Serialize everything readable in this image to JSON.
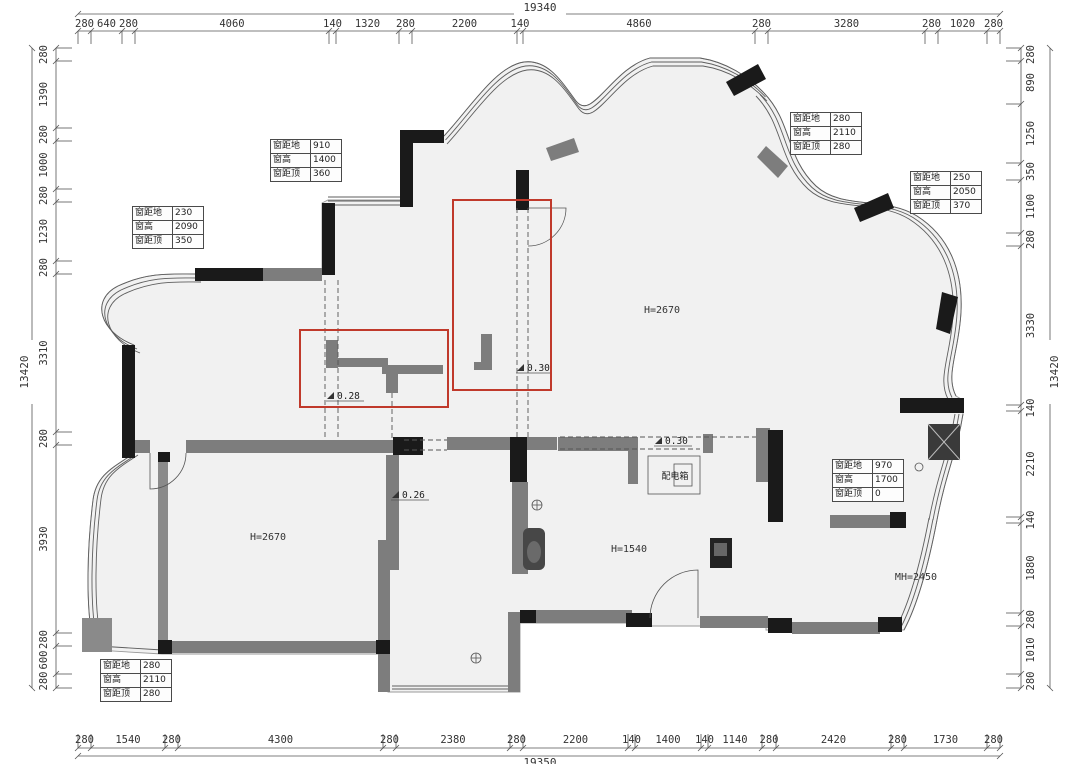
{
  "colors": {
    "wall_black": "#1a1a1a",
    "wall_gray": "#7d7d7d",
    "floor_fill": "#f1f1f1",
    "highlight_red": "#c0392b",
    "dim_line": "#555555"
  },
  "dimensions": {
    "top": {
      "total": "19340",
      "segments": [
        "280",
        "640",
        "280",
        "4060",
        "140",
        "1320",
        "280",
        "2200",
        "140",
        "4860",
        "280",
        "3280",
        "280",
        "1020",
        "280"
      ]
    },
    "bottom": {
      "total": "19350",
      "segments": [
        "280",
        "1540",
        "280",
        "4300",
        "280",
        "2380",
        "280",
        "2200",
        "140",
        "1400",
        "140",
        "1140",
        "280",
        "2420",
        "280",
        "1730",
        "280"
      ]
    },
    "left": {
      "total": "13420",
      "segments": [
        "280",
        "1390",
        "280",
        "1000",
        "280",
        "1230",
        "280",
        "3310",
        "280",
        "3930",
        "280",
        "600",
        "280"
      ]
    },
    "right": {
      "total": "13420",
      "segments": [
        "280",
        "890",
        "1250",
        "350",
        "1100",
        "280",
        "3330",
        "140",
        "2210",
        "140",
        "1880",
        "280",
        "1010",
        "280"
      ]
    }
  },
  "window_annotations": [
    {
      "id": "top-left-window",
      "rows": [
        {
          "label": "窗距地",
          "value": "910"
        },
        {
          "label": "窗高",
          "value": "1400"
        },
        {
          "label": "窗距顶",
          "value": "360"
        }
      ]
    },
    {
      "id": "left-bay-window",
      "rows": [
        {
          "label": "窗距地",
          "value": "230"
        },
        {
          "label": "窗高",
          "value": "2090"
        },
        {
          "label": "窗距顶",
          "value": "350"
        }
      ]
    },
    {
      "id": "top-right-window",
      "rows": [
        {
          "label": "窗距地",
          "value": "280"
        },
        {
          "label": "窗高",
          "value": "2110"
        },
        {
          "label": "窗距顶",
          "value": "280"
        }
      ]
    },
    {
      "id": "right-bay-window",
      "rows": [
        {
          "label": "窗距地",
          "value": "250"
        },
        {
          "label": "窗高",
          "value": "2050"
        },
        {
          "label": "窗距顶",
          "value": "370"
        }
      ]
    },
    {
      "id": "kitchen-window",
      "rows": [
        {
          "label": "窗距地",
          "value": "970"
        },
        {
          "label": "窗高",
          "value": "1700"
        },
        {
          "label": "窗距顶",
          "value": "0"
        }
      ]
    },
    {
      "id": "balcony-window",
      "rows": [
        {
          "label": "窗距地",
          "value": "280"
        },
        {
          "label": "窗高",
          "value": "2110"
        },
        {
          "label": "窗距顶",
          "value": "280"
        }
      ]
    }
  ],
  "labels": {
    "living_height": "H=2670",
    "bedroom_height": "H=2670",
    "master_height": "MH=2450",
    "passage_height": "H=1540",
    "distribution_box": "配电箱"
  },
  "level_marks": [
    {
      "value": "0.28"
    },
    {
      "value": "0.26"
    },
    {
      "value": "0.30"
    },
    {
      "value": "0.30"
    }
  ]
}
